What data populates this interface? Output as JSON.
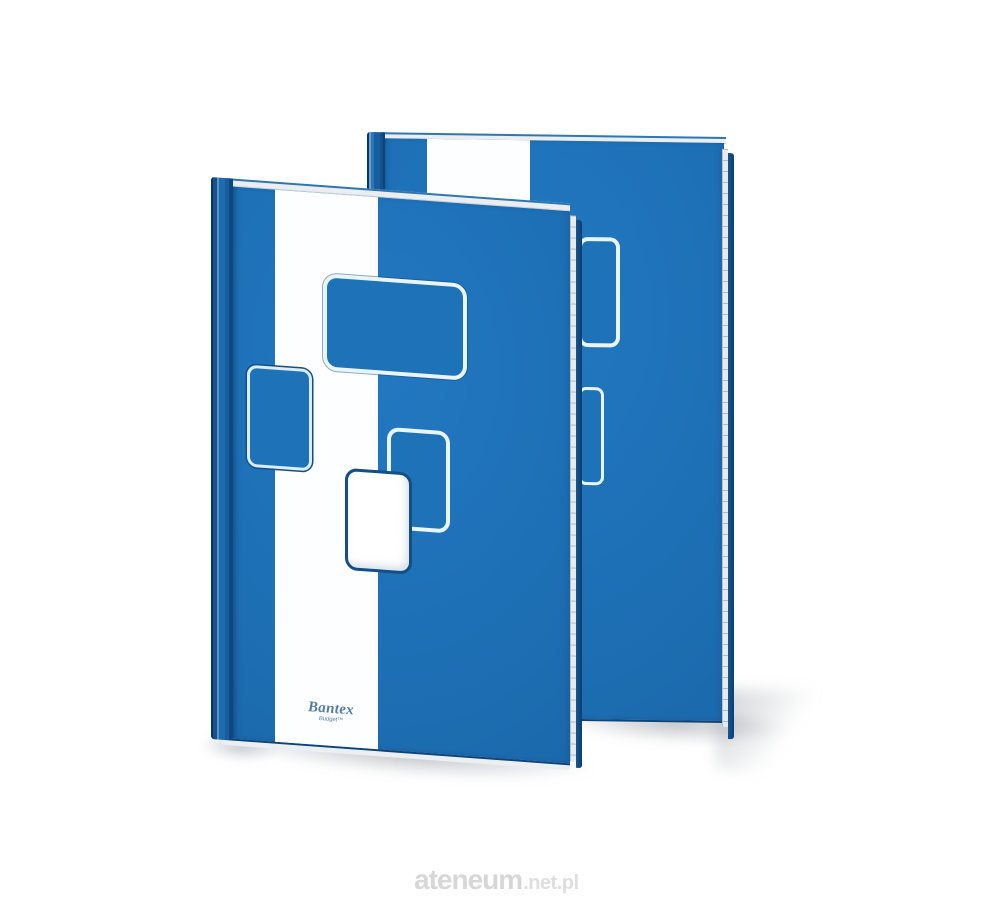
{
  "scene": {
    "description": "Product photo of two matching blue hardcover notebooks standing upright, the front one showing a cover design with a white vertical stripe, four rounded-rectangle graphics and the Bantex Budget logo; light studio shadow beneath",
    "background_color": "#ffffff"
  },
  "brand": {
    "name": "Bantex",
    "sub_brand": "Budget™",
    "logo_color": "#527ca6"
  },
  "watermark": {
    "site": "ateneum",
    "suffix": ".net.pl",
    "color": "#d7d7d7"
  },
  "colors": {
    "cover_blue": "#1e72b8",
    "cover_blue_deep": "#1a65a8",
    "spine_navy": "#0c3c6c",
    "stripe_white": "#ffffff",
    "outline_light": "#e9f5fd",
    "outline_dark": "#164e84",
    "pages_edge": "#e8ecef",
    "shadow_gray": "#5f6973"
  }
}
